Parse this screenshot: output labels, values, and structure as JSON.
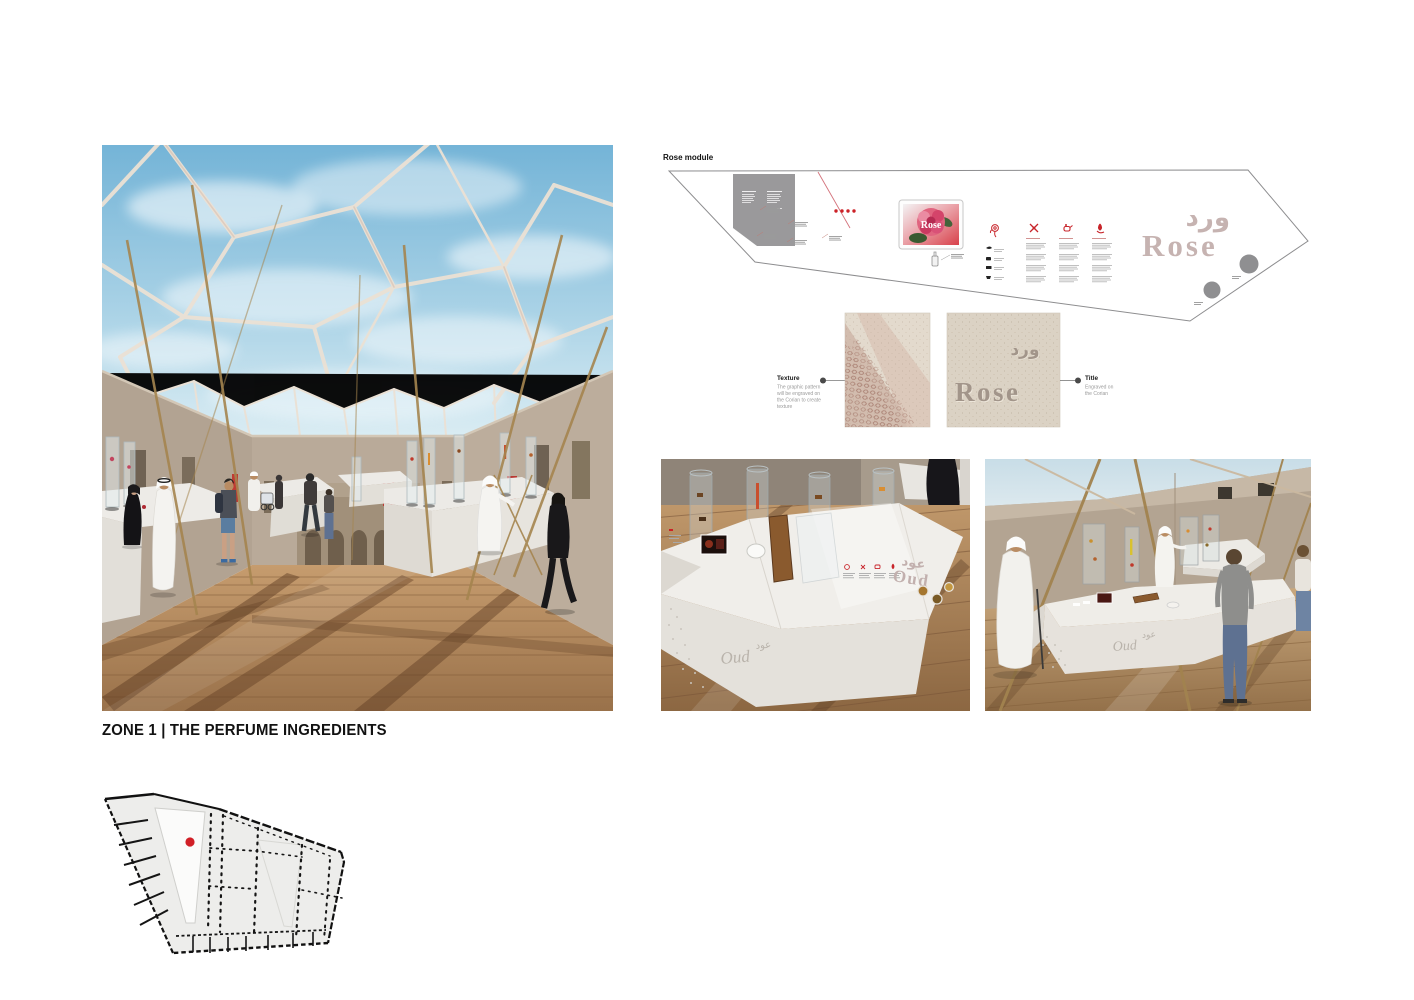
{
  "zone": {
    "title": "ZONE 1 | THE PERFUME INGREDIENTS"
  },
  "rose_module": {
    "label": "Rose module",
    "title_ar": "ورد",
    "title_en": "Rose",
    "screen_title": "Rose",
    "colors": {
      "accent_red": "#cc2127",
      "engraved_title": "#c6b3b1",
      "panel_gray": "#9a999b",
      "dot_gray": "#8f8f91"
    }
  },
  "texture_detail": {
    "texture": {
      "label": "Texture",
      "note_lines": [
        "The graphic pattern",
        "will be engraved on",
        "the Corian to create",
        "texture"
      ]
    },
    "title": {
      "label": "Title",
      "note_lines": [
        "Engraved on",
        "the Corian"
      ]
    },
    "engraved_ar": "ورد",
    "engraved_en": "Rose"
  },
  "oud_modules": {
    "closeup": {
      "title_ar": "عود",
      "title_en": "Oud",
      "engraved_script": "Oud",
      "engraved_ar": "عود"
    },
    "courtyard": {
      "engraved_script": "Oud",
      "engraved_ar": "عود"
    }
  },
  "floor_plan": {
    "marker_color": "#d11f26"
  }
}
